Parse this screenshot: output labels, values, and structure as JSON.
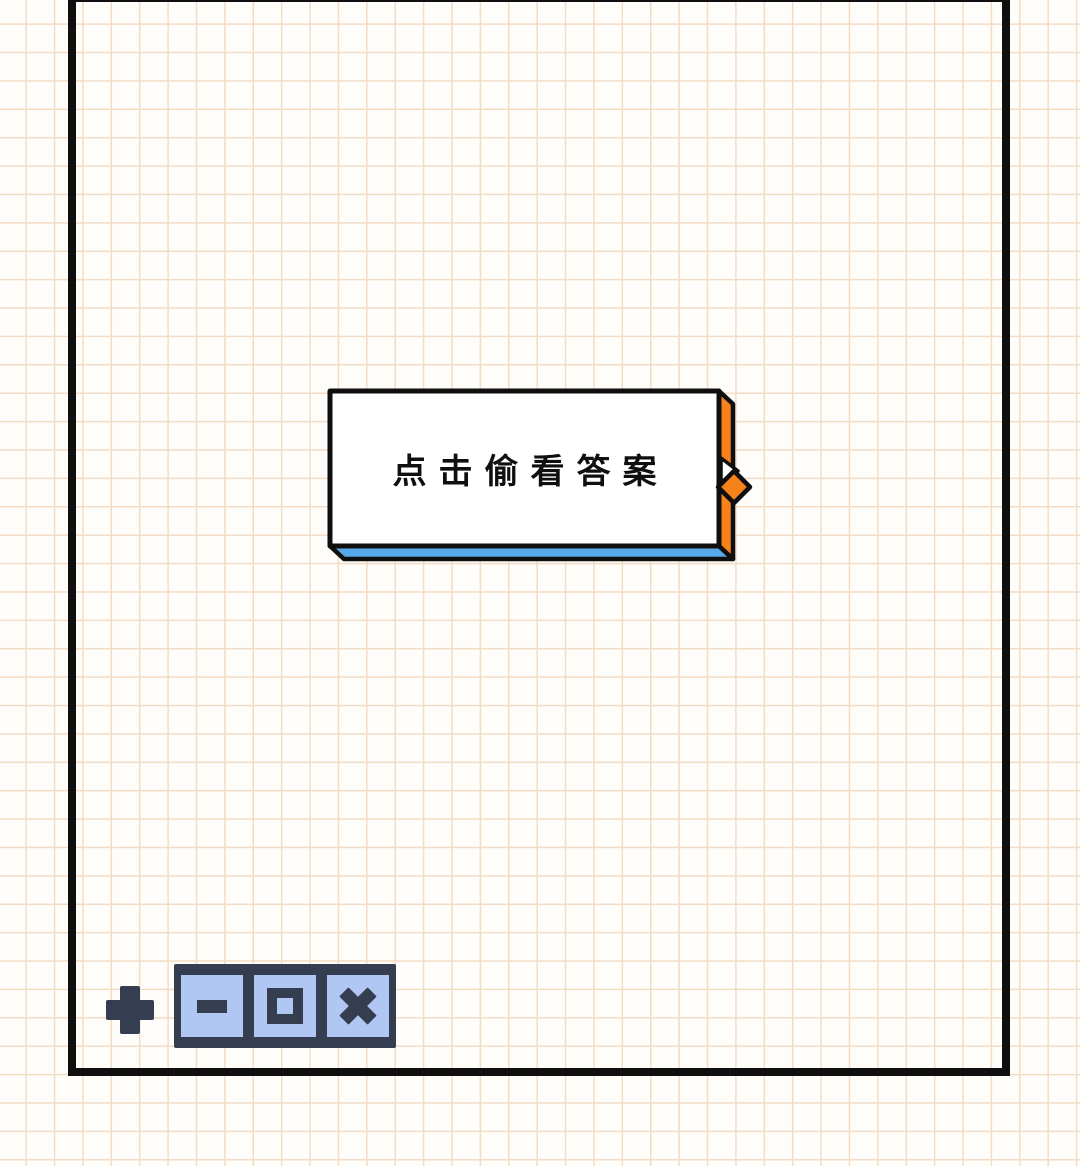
{
  "answer_button": {
    "label": "点击偷看答案"
  },
  "icons": {
    "plus": "plus-icon",
    "minimize": "minus-icon",
    "maximize": "square-icon",
    "close": "x-icon",
    "pointer": "diamond-pointer-icon"
  },
  "colors": {
    "paper": "#fffdf9",
    "grid": "#f3dcc6",
    "ink": "#0f0f0f",
    "accent-orange": "#f6821c",
    "accent-blue": "#58a9ea",
    "navy": "#353d50",
    "periwinkle": "#b1c7f3",
    "button-face": "#ffffff"
  }
}
